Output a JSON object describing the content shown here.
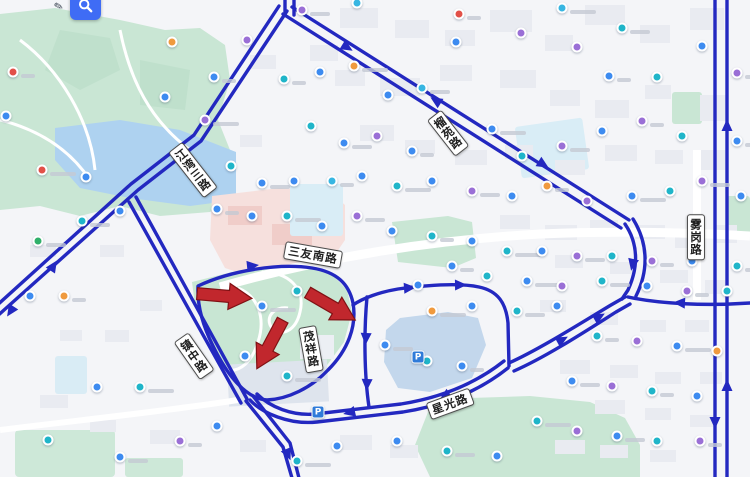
{
  "app": {
    "type": "chinese-web-map-route-view",
    "controls": {
      "search_icon": "magnifier",
      "edit_icon": "pen"
    }
  },
  "colors": {
    "route_blue": "#2328c0",
    "annotation_red": "#c1272d",
    "annotation_red_border": "#801114",
    "water": "#aed2f0",
    "pond": "#c3d7ec",
    "park_green": "#c9e6d4",
    "pink_area": "#f6e0dd",
    "cyan_area": "#d9edf6",
    "building": "#e9ebf1",
    "search_button_blue": "#3f6cf5",
    "marker_palette": {
      "b": "#3d8bf0",
      "t": "#1fb5c9",
      "p": "#9a6fd6",
      "o": "#f09a3e",
      "r": "#e25048",
      "g": "#30b06a",
      "c": "#37b6e2"
    }
  },
  "road_labels": [
    {
      "text": "江湾三路",
      "x": 193,
      "y": 170,
      "rotation": -38,
      "vertical": true
    },
    {
      "text": "榴苑路",
      "x": 448,
      "y": 133,
      "rotation": -38,
      "vertical": true
    },
    {
      "text": "三友南路",
      "x": 313,
      "y": 255,
      "rotation": 10,
      "vertical": false
    },
    {
      "text": "镇中路",
      "x": 194,
      "y": 356,
      "rotation": -35,
      "vertical": true
    },
    {
      "text": "茂祥路",
      "x": 311,
      "y": 349,
      "rotation": -10,
      "vertical": true
    },
    {
      "text": "雾岗路",
      "x": 696,
      "y": 237,
      "rotation": 0,
      "vertical": true
    },
    {
      "text": "星光路",
      "x": 450,
      "y": 404,
      "rotation": -20,
      "vertical": false
    }
  ],
  "annotation_arrows": [
    {
      "x": 224,
      "y": 296,
      "rotation": 5
    },
    {
      "x": 270,
      "y": 344,
      "rotation": 118
    },
    {
      "x": 331,
      "y": 306,
      "rotation": 30
    }
  ],
  "routes": [
    {
      "d": "M715,-5 L715,482"
    },
    {
      "d": "M727,-5 L727,482"
    },
    {
      "d": "M750,303 C706,306 660,304 628,297"
    },
    {
      "d": "M285,-6 L285,15"
    },
    {
      "d": "M294,-6 L294,15"
    },
    {
      "d": "M283,14 L621,228"
    },
    {
      "d": "M292,7 L629,220"
    },
    {
      "d": "M625,224 C638,243 639,266 628,290 C626,293 624,296 622,299"
    },
    {
      "d": "M633,219 C648,243 649,270 636,296"
    },
    {
      "d": "M287,11 L201,141 L138,190 L-6,319"
    },
    {
      "d": "M279,6 L194,135 L131,184 L-6,308"
    },
    {
      "d": "M136,197 L247,399"
    },
    {
      "d": "M129,202 L241,403"
    },
    {
      "d": "M198,286 C232,270 280,263 312,268 C337,272 349,284 353,303 C357,326 348,350 328,370 C311,388 288,399 267,400 C247,399 228,377 213,346 C202,324 197,305 198,286 Z"
    },
    {
      "d": "M367,297 C364,330 364,373 369,407"
    },
    {
      "d": "M353,305 C363,298 380,292 398,289 C428,285 460,283 479,287 C498,291 506,303 508,323 L509,366"
    },
    {
      "d": "M509,363 C540,349 581,323 611,305 L625,297"
    },
    {
      "d": "M514,371 C546,357 586,331 616,312 L630,304"
    },
    {
      "d": "M508,368 C478,392 441,406 403,412 L317,422 C289,425 262,413 250,400"
    },
    {
      "d": "M504,361 C475,384 439,398 401,404 L315,414 C292,416 270,407 257,394"
    },
    {
      "d": "M246,401 L283,447 L292,478"
    },
    {
      "d": "M253,396 L290,443 L299,478"
    }
  ],
  "route_arrows": [
    {
      "x": 345,
      "y": 46,
      "a": 32
    },
    {
      "x": 438,
      "y": 102,
      "a": 212
    },
    {
      "x": 541,
      "y": 163,
      "a": 32
    },
    {
      "x": 52,
      "y": 268,
      "a": -57
    },
    {
      "x": 12,
      "y": 309,
      "a": 123
    },
    {
      "x": 727,
      "y": 128,
      "a": -90
    },
    {
      "x": 727,
      "y": 388,
      "a": -90
    },
    {
      "x": 715,
      "y": 420,
      "a": 90
    },
    {
      "x": 682,
      "y": 303,
      "a": 183
    },
    {
      "x": 633,
      "y": 262,
      "a": 102
    },
    {
      "x": 560,
      "y": 341,
      "a": -29
    },
    {
      "x": 597,
      "y": 318,
      "a": -30
    },
    {
      "x": 407,
      "y": 288,
      "a": -4
    },
    {
      "x": 458,
      "y": 285,
      "a": -1
    },
    {
      "x": 366,
      "y": 336,
      "a": 93
    },
    {
      "x": 367,
      "y": 382,
      "a": 92
    },
    {
      "x": 447,
      "y": 395,
      "a": 147
    },
    {
      "x": 352,
      "y": 412,
      "a": 167
    },
    {
      "x": 287,
      "y": 452,
      "a": 67
    },
    {
      "x": 250,
      "y": 266,
      "a": -6
    }
  ],
  "parking_markers": [
    {
      "x": 318,
      "y": 412,
      "label": "P"
    },
    {
      "x": 418,
      "y": 357,
      "label": "P"
    }
  ],
  "poi_markers": [
    [
      13,
      72,
      "r"
    ],
    [
      6,
      116,
      "b"
    ],
    [
      42,
      170,
      "r"
    ],
    [
      86,
      177,
      "b"
    ],
    [
      38,
      241,
      "g"
    ],
    [
      30,
      296,
      "b"
    ],
    [
      64,
      296,
      "o"
    ],
    [
      97,
      387,
      "b"
    ],
    [
      140,
      387,
      "t"
    ],
    [
      48,
      440,
      "t"
    ],
    [
      120,
      457,
      "b"
    ],
    [
      172,
      42,
      "o"
    ],
    [
      214,
      77,
      "b"
    ],
    [
      165,
      97,
      "b"
    ],
    [
      205,
      120,
      "p"
    ],
    [
      247,
      40,
      "p"
    ],
    [
      302,
      10,
      "p"
    ],
    [
      357,
      3,
      "c"
    ],
    [
      284,
      79,
      "t"
    ],
    [
      320,
      72,
      "b"
    ],
    [
      354,
      66,
      "o"
    ],
    [
      388,
      95,
      "b"
    ],
    [
      422,
      88,
      "c"
    ],
    [
      456,
      42,
      "b"
    ],
    [
      459,
      14,
      "r"
    ],
    [
      521,
      33,
      "p"
    ],
    [
      562,
      8,
      "c"
    ],
    [
      577,
      47,
      "p"
    ],
    [
      622,
      28,
      "t"
    ],
    [
      657,
      77,
      "t"
    ],
    [
      609,
      76,
      "b"
    ],
    [
      702,
      46,
      "b"
    ],
    [
      737,
      73,
      "p"
    ],
    [
      311,
      126,
      "t"
    ],
    [
      344,
      143,
      "b"
    ],
    [
      377,
      136,
      "p"
    ],
    [
      412,
      151,
      "b"
    ],
    [
      450,
      136,
      "o"
    ],
    [
      492,
      129,
      "b"
    ],
    [
      522,
      156,
      "t"
    ],
    [
      562,
      146,
      "p"
    ],
    [
      602,
      131,
      "b"
    ],
    [
      642,
      121,
      "p"
    ],
    [
      682,
      136,
      "t"
    ],
    [
      737,
      141,
      "b"
    ],
    [
      231,
      166,
      "t"
    ],
    [
      262,
      183,
      "b"
    ],
    [
      294,
      181,
      "b"
    ],
    [
      332,
      181,
      "c"
    ],
    [
      362,
      176,
      "b"
    ],
    [
      397,
      186,
      "t"
    ],
    [
      432,
      181,
      "b"
    ],
    [
      472,
      191,
      "p"
    ],
    [
      512,
      196,
      "b"
    ],
    [
      547,
      186,
      "o"
    ],
    [
      587,
      201,
      "p"
    ],
    [
      632,
      196,
      "b"
    ],
    [
      670,
      191,
      "t"
    ],
    [
      702,
      181,
      "p"
    ],
    [
      741,
      196,
      "b"
    ],
    [
      217,
      209,
      "b"
    ],
    [
      252,
      216,
      "b"
    ],
    [
      287,
      216,
      "t"
    ],
    [
      322,
      226,
      "b"
    ],
    [
      357,
      216,
      "p"
    ],
    [
      392,
      231,
      "b"
    ],
    [
      432,
      236,
      "t"
    ],
    [
      472,
      241,
      "b"
    ],
    [
      507,
      251,
      "t"
    ],
    [
      542,
      251,
      "b"
    ],
    [
      577,
      256,
      "p"
    ],
    [
      612,
      256,
      "t"
    ],
    [
      652,
      261,
      "p"
    ],
    [
      692,
      261,
      "b"
    ],
    [
      737,
      266,
      "t"
    ],
    [
      120,
      211,
      "b"
    ],
    [
      82,
      221,
      "t"
    ],
    [
      418,
      285,
      "b"
    ],
    [
      452,
      266,
      "b"
    ],
    [
      487,
      276,
      "t"
    ],
    [
      527,
      281,
      "b"
    ],
    [
      562,
      286,
      "p"
    ],
    [
      602,
      281,
      "t"
    ],
    [
      647,
      286,
      "b"
    ],
    [
      687,
      291,
      "p"
    ],
    [
      727,
      291,
      "t"
    ],
    [
      432,
      311,
      "o"
    ],
    [
      472,
      306,
      "b"
    ],
    [
      517,
      311,
      "t"
    ],
    [
      557,
      306,
      "b"
    ],
    [
      597,
      336,
      "t"
    ],
    [
      637,
      341,
      "p"
    ],
    [
      677,
      346,
      "b"
    ],
    [
      717,
      351,
      "o"
    ],
    [
      572,
      381,
      "b"
    ],
    [
      612,
      386,
      "p"
    ],
    [
      652,
      391,
      "t"
    ],
    [
      697,
      396,
      "b"
    ],
    [
      537,
      421,
      "t"
    ],
    [
      577,
      431,
      "p"
    ],
    [
      617,
      436,
      "b"
    ],
    [
      657,
      441,
      "t"
    ],
    [
      700,
      441,
      "p"
    ],
    [
      337,
      446,
      "b"
    ],
    [
      297,
      461,
      "t"
    ],
    [
      397,
      441,
      "b"
    ],
    [
      447,
      451,
      "t"
    ],
    [
      497,
      456,
      "b"
    ],
    [
      180,
      441,
      "p"
    ],
    [
      217,
      426,
      "b"
    ],
    [
      262,
      306,
      "b"
    ],
    [
      297,
      291,
      "t"
    ],
    [
      385,
      345,
      "b"
    ],
    [
      427,
      361,
      "t"
    ],
    [
      462,
      366,
      "b"
    ],
    [
      245,
      356,
      "b"
    ],
    [
      287,
      376,
      "t"
    ]
  ]
}
